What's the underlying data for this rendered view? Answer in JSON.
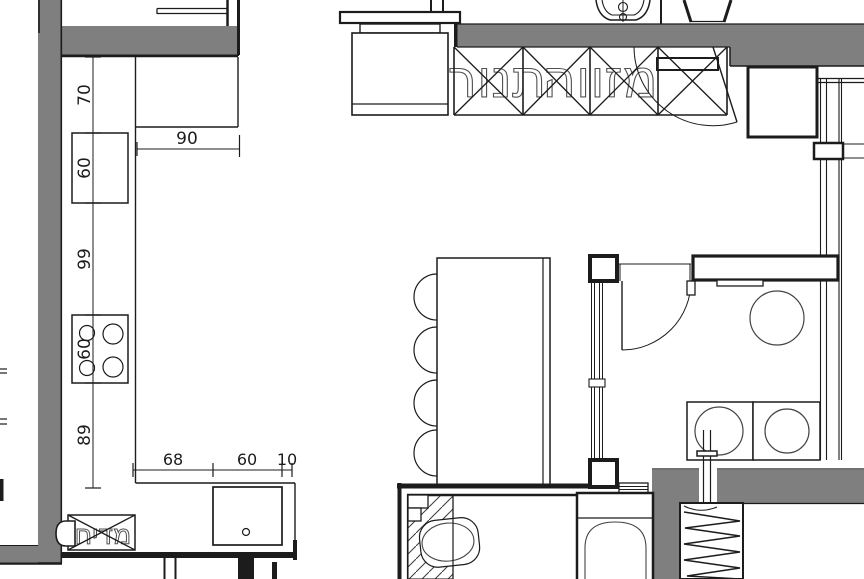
{
  "plan": {
    "labels": {
      "upper_cabinet_pantry": "מזווה",
      "upper_cabinet_oven": "תנור",
      "dishwasher": "מדיח"
    },
    "dimensions": {
      "left_chain": [
        "70",
        "60",
        "99",
        "60",
        "89"
      ],
      "top_width": "90",
      "bottom_chain": [
        "68",
        "60",
        "10"
      ]
    },
    "colors": {
      "wall": "#7f7f7f",
      "line": "#1c1c1c",
      "text": "#4f4f4f"
    }
  }
}
